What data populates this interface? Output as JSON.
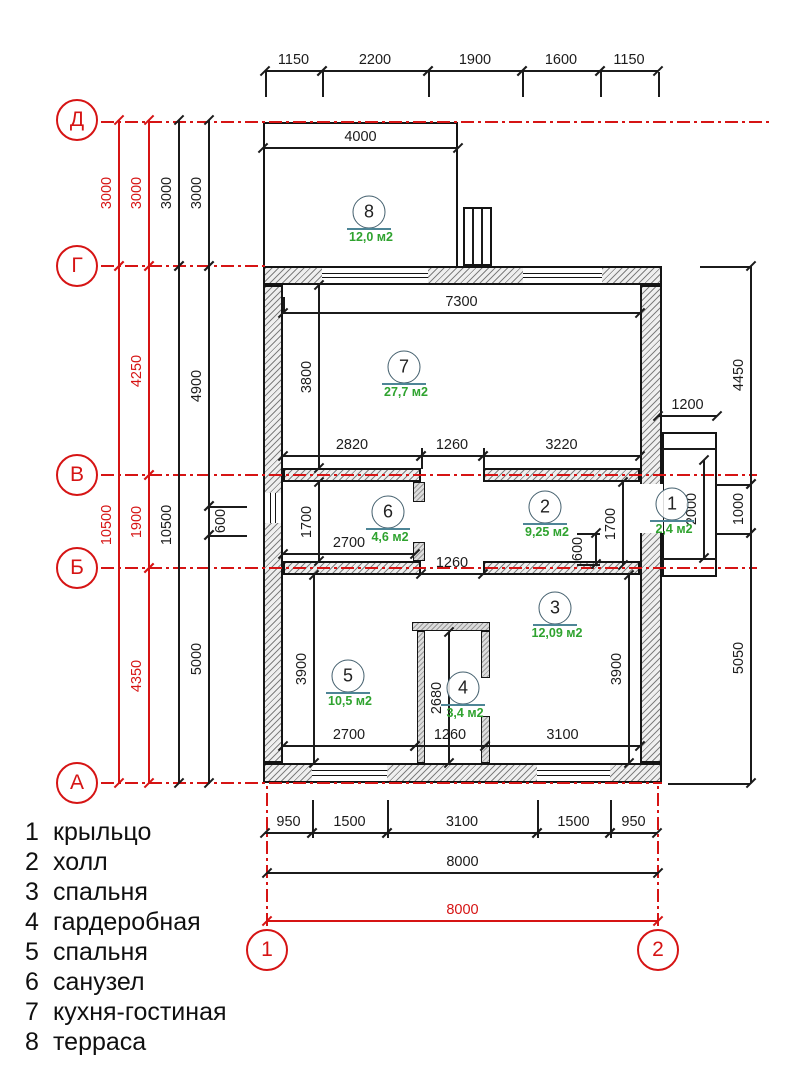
{
  "colors": {
    "red": "#d61414",
    "black": "#1b1b1b",
    "green": "#2fa32f",
    "bar": "#4e8596",
    "wall_edge": "#141414"
  },
  "axis_circles": [
    {
      "label": "Д",
      "cx": 77,
      "cy": 120
    },
    {
      "label": "Г",
      "cx": 77,
      "cy": 266
    },
    {
      "label": "В",
      "cx": 77,
      "cy": 475
    },
    {
      "label": "Б",
      "cx": 77,
      "cy": 568
    },
    {
      "label": "А",
      "cx": 77,
      "cy": 783
    },
    {
      "label": "1",
      "cx": 267,
      "cy": 950
    },
    {
      "label": "2",
      "cx": 658,
      "cy": 950
    }
  ],
  "rooms": [
    {
      "num": "8",
      "area": "12,0 м2",
      "cx": 369,
      "cy": 212
    },
    {
      "num": "7",
      "area": "27,7 м2",
      "cx": 404,
      "cy": 367
    },
    {
      "num": "6",
      "area": "4,6 м2",
      "cx": 388,
      "cy": 512
    },
    {
      "num": "2",
      "area": "9,25 м2",
      "cx": 545,
      "cy": 507
    },
    {
      "num": "1",
      "area": "2,4 м2",
      "cx": 672,
      "cy": 504
    },
    {
      "num": "3",
      "area": "12,09 м2",
      "cx": 555,
      "cy": 608
    },
    {
      "num": "5",
      "area": "10,5 м2",
      "cx": 348,
      "cy": 676
    },
    {
      "num": "4",
      "area": "3,4 м2",
      "cx": 463,
      "cy": 688
    }
  ],
  "legend": {
    "items": [
      {
        "num": "1",
        "label": "крыльцо"
      },
      {
        "num": "2",
        "label": "холл"
      },
      {
        "num": "3",
        "label": "спальня"
      },
      {
        "num": "4",
        "label": "гардеробная"
      },
      {
        "num": "5",
        "label": "спальня"
      },
      {
        "num": "6",
        "label": "санузел"
      },
      {
        "num": "7",
        "label": "кухня-гостиная"
      },
      {
        "num": "8",
        "label": "терраса"
      }
    ]
  },
  "dims": [
    {
      "o": "h",
      "x": 265,
      "y": 70,
      "len": 57,
      "t": "1150"
    },
    {
      "o": "h",
      "x": 322,
      "y": 70,
      "len": 106,
      "t": "2200"
    },
    {
      "o": "h",
      "x": 428,
      "y": 70,
      "len": 94,
      "t": "1900"
    },
    {
      "o": "h",
      "x": 522,
      "y": 70,
      "len": 78,
      "t": "1600"
    },
    {
      "o": "h",
      "x": 600,
      "y": 70,
      "len": 58,
      "t": "1150"
    },
    {
      "o": "h",
      "x": 263,
      "y": 147,
      "len": 195,
      "t": "4000"
    },
    {
      "o": "v",
      "x": 118,
      "y": 120,
      "len": 146,
      "t": "3000",
      "c": "r"
    },
    {
      "o": "v",
      "x": 118,
      "y": 266,
      "len": 517,
      "t": "10500",
      "c": "r"
    },
    {
      "o": "v",
      "x": 148,
      "y": 120,
      "len": 146,
      "t": "3000",
      "c": "r"
    },
    {
      "o": "v",
      "x": 148,
      "y": 266,
      "len": 209,
      "t": "4250",
      "c": "r"
    },
    {
      "o": "v",
      "x": 148,
      "y": 475,
      "len": 93,
      "t": "1900",
      "c": "r"
    },
    {
      "o": "v",
      "x": 148,
      "y": 568,
      "len": 215,
      "t": "4350",
      "c": "r"
    },
    {
      "o": "v",
      "x": 178,
      "y": 120,
      "len": 146,
      "t": "3000"
    },
    {
      "o": "v",
      "x": 178,
      "y": 266,
      "len": 517,
      "t": "10500"
    },
    {
      "o": "v",
      "x": 208,
      "y": 120,
      "len": 146,
      "t": "3000"
    },
    {
      "o": "v",
      "x": 208,
      "y": 266,
      "len": 240,
      "t": "4900"
    },
    {
      "o": "v",
      "x": 208,
      "y": 506,
      "len": 29,
      "t": "600",
      "lx": 221
    },
    {
      "o": "v",
      "x": 208,
      "y": 535,
      "len": 248,
      "t": "5000"
    },
    {
      "o": "v",
      "x": 750,
      "y": 266,
      "len": 218,
      "t": "4450"
    },
    {
      "o": "v",
      "x": 750,
      "y": 484,
      "len": 49,
      "t": "1000"
    },
    {
      "o": "v",
      "x": 750,
      "y": 533,
      "len": 250,
      "t": "5050"
    },
    {
      "o": "h",
      "x": 658,
      "y": 415,
      "len": 59,
      "t": "1200"
    },
    {
      "o": "v",
      "x": 703,
      "y": 460,
      "len": 98,
      "t": "2000"
    },
    {
      "o": "h",
      "x": 283,
      "y": 312,
      "len": 357,
      "t": "7300"
    },
    {
      "o": "v",
      "x": 318,
      "y": 285,
      "len": 183,
      "t": "3800"
    },
    {
      "o": "h",
      "x": 283,
      "y": 455,
      "len": 138,
      "t": "2820"
    },
    {
      "o": "h",
      "x": 421,
      "y": 455,
      "len": 62,
      "t": "1260"
    },
    {
      "o": "h",
      "x": 483,
      "y": 455,
      "len": 157,
      "t": "3220"
    },
    {
      "o": "v",
      "x": 318,
      "y": 482,
      "len": 79,
      "t": "1700"
    },
    {
      "o": "h",
      "x": 283,
      "y": 553,
      "len": 132,
      "t": "2700"
    },
    {
      "o": "h",
      "x": 421,
      "y": 573,
      "len": 62,
      "t": "1260"
    },
    {
      "o": "v",
      "x": 622,
      "y": 482,
      "len": 83,
      "t": "1700"
    },
    {
      "o": "v",
      "x": 595,
      "y": 533,
      "len": 31,
      "t": "600",
      "lx": 578
    },
    {
      "o": "v",
      "x": 448,
      "y": 632,
      "len": 131,
      "t": "2680"
    },
    {
      "o": "v",
      "x": 313,
      "y": 575,
      "len": 188,
      "t": "3900"
    },
    {
      "o": "v",
      "x": 628,
      "y": 575,
      "len": 188,
      "t": "3900"
    },
    {
      "o": "h",
      "x": 283,
      "y": 745,
      "len": 132,
      "t": "2700"
    },
    {
      "o": "h",
      "x": 415,
      "y": 745,
      "len": 70,
      "t": "1260"
    },
    {
      "o": "h",
      "x": 485,
      "y": 745,
      "len": 155,
      "t": "3100"
    },
    {
      "o": "h",
      "x": 265,
      "y": 832,
      "len": 47,
      "t": "950"
    },
    {
      "o": "h",
      "x": 312,
      "y": 832,
      "len": 75,
      "t": "1500"
    },
    {
      "o": "h",
      "x": 387,
      "y": 832,
      "len": 150,
      "t": "3100"
    },
    {
      "o": "h",
      "x": 537,
      "y": 832,
      "len": 73,
      "t": "1500"
    },
    {
      "o": "h",
      "x": 610,
      "y": 832,
      "len": 47,
      "t": "950"
    },
    {
      "o": "h",
      "x": 267,
      "y": 872,
      "len": 391,
      "t": "8000"
    },
    {
      "o": "h",
      "x": 267,
      "y": 920,
      "len": 391,
      "t": "8000",
      "c": "r"
    }
  ],
  "walls": [
    {
      "x": 263,
      "y": 266,
      "w": 399,
      "h": 19
    },
    {
      "x": 263,
      "y": 763,
      "w": 399,
      "h": 20
    },
    {
      "x": 263,
      "y": 285,
      "w": 20,
      "h": 478
    },
    {
      "x": 640,
      "y": 285,
      "w": 22,
      "h": 478
    },
    {
      "x": 283,
      "y": 468,
      "w": 138,
      "h": 14
    },
    {
      "x": 483,
      "y": 468,
      "w": 157,
      "h": 14
    },
    {
      "x": 283,
      "y": 561,
      "w": 138,
      "h": 14
    },
    {
      "x": 483,
      "y": 561,
      "w": 157,
      "h": 14
    },
    {
      "x": 413,
      "y": 482,
      "w": 12,
      "h": 20,
      "s": "solid"
    },
    {
      "x": 413,
      "y": 542,
      "w": 12,
      "h": 19,
      "s": "solid"
    },
    {
      "x": 412,
      "y": 622,
      "w": 78,
      "h": 9,
      "s": "solid"
    },
    {
      "x": 417,
      "y": 631,
      "w": 8,
      "h": 132,
      "s": "solid"
    },
    {
      "x": 481,
      "y": 631,
      "w": 9,
      "h": 47,
      "s": "solid"
    },
    {
      "x": 481,
      "y": 716,
      "w": 9,
      "h": 47,
      "s": "solid"
    }
  ],
  "windows": [
    {
      "x": 322,
      "y": 266,
      "w": 106,
      "h": 19,
      "o": "h"
    },
    {
      "x": 523,
      "y": 266,
      "w": 79,
      "h": 19,
      "o": "h"
    },
    {
      "x": 312,
      "y": 763,
      "w": 75,
      "h": 20,
      "o": "h"
    },
    {
      "x": 537,
      "y": 763,
      "w": 73,
      "h": 20,
      "o": "h"
    },
    {
      "x": 263,
      "y": 493,
      "w": 20,
      "h": 30,
      "o": "v"
    },
    {
      "x": 639,
      "y": 484,
      "w": 24,
      "h": 49,
      "o": "door"
    }
  ],
  "outline_rects": [
    {
      "name": "terrace-outline",
      "x": 263,
      "y": 122,
      "w": 195,
      "h": 146,
      "open": true
    },
    {
      "name": "chimney-outline",
      "x": 463,
      "y": 207,
      "w": 29,
      "h": 59,
      "open": false
    },
    {
      "name": "porch-outline",
      "x": 662,
      "y": 432,
      "w": 55,
      "h": 145,
      "open": false
    }
  ],
  "xlines": [
    {
      "o": "v",
      "x": 472,
      "y": 209,
      "len": 55
    },
    {
      "o": "v",
      "x": 481,
      "y": 209,
      "len": 55
    },
    {
      "o": "h",
      "x": 662,
      "y": 448,
      "len": 55
    },
    {
      "o": "h",
      "x": 662,
      "y": 558,
      "len": 55
    },
    {
      "o": "v",
      "x": 265,
      "y": 72,
      "len": 25
    },
    {
      "o": "v",
      "x": 322,
      "y": 72,
      "len": 25
    },
    {
      "o": "v",
      "x": 428,
      "y": 72,
      "len": 25
    },
    {
      "o": "v",
      "x": 522,
      "y": 72,
      "len": 25
    },
    {
      "o": "v",
      "x": 600,
      "y": 72,
      "len": 25
    },
    {
      "o": "v",
      "x": 658,
      "y": 72,
      "len": 25
    },
    {
      "o": "h",
      "x": 700,
      "y": 266,
      "len": 50
    },
    {
      "o": "h",
      "x": 716,
      "y": 484,
      "len": 34
    },
    {
      "o": "h",
      "x": 716,
      "y": 533,
      "len": 34
    },
    {
      "o": "h",
      "x": 668,
      "y": 783,
      "len": 82
    },
    {
      "o": "h",
      "x": 208,
      "y": 506,
      "len": 39
    },
    {
      "o": "h",
      "x": 208,
      "y": 535,
      "len": 39
    },
    {
      "o": "h",
      "x": 577,
      "y": 533,
      "len": 23
    },
    {
      "o": "h",
      "x": 577,
      "y": 564,
      "len": 23
    },
    {
      "o": "v",
      "x": 312,
      "y": 800,
      "len": 38
    },
    {
      "o": "v",
      "x": 387,
      "y": 800,
      "len": 38
    },
    {
      "o": "v",
      "x": 537,
      "y": 800,
      "len": 38
    },
    {
      "o": "v",
      "x": 610,
      "y": 800,
      "len": 38
    },
    {
      "o": "v",
      "x": 283,
      "y": 297,
      "len": 16
    },
    {
      "o": "v",
      "x": 640,
      "y": 297,
      "len": 16
    },
    {
      "o": "v",
      "x": 421,
      "y": 448,
      "len": 21
    },
    {
      "o": "v",
      "x": 483,
      "y": 448,
      "len": 21
    }
  ],
  "axlines": [
    {
      "o": "h",
      "x": 101,
      "y": 122,
      "len": 669
    },
    {
      "o": "h",
      "x": 101,
      "y": 266,
      "len": 164
    },
    {
      "o": "h",
      "x": 101,
      "y": 475,
      "len": 656
    },
    {
      "o": "h",
      "x": 101,
      "y": 568,
      "len": 656
    },
    {
      "o": "h",
      "x": 101,
      "y": 783,
      "len": 561
    },
    {
      "o": "v",
      "x": 267,
      "y": 786,
      "len": 140
    },
    {
      "o": "v",
      "x": 658,
      "y": 786,
      "len": 140
    }
  ]
}
